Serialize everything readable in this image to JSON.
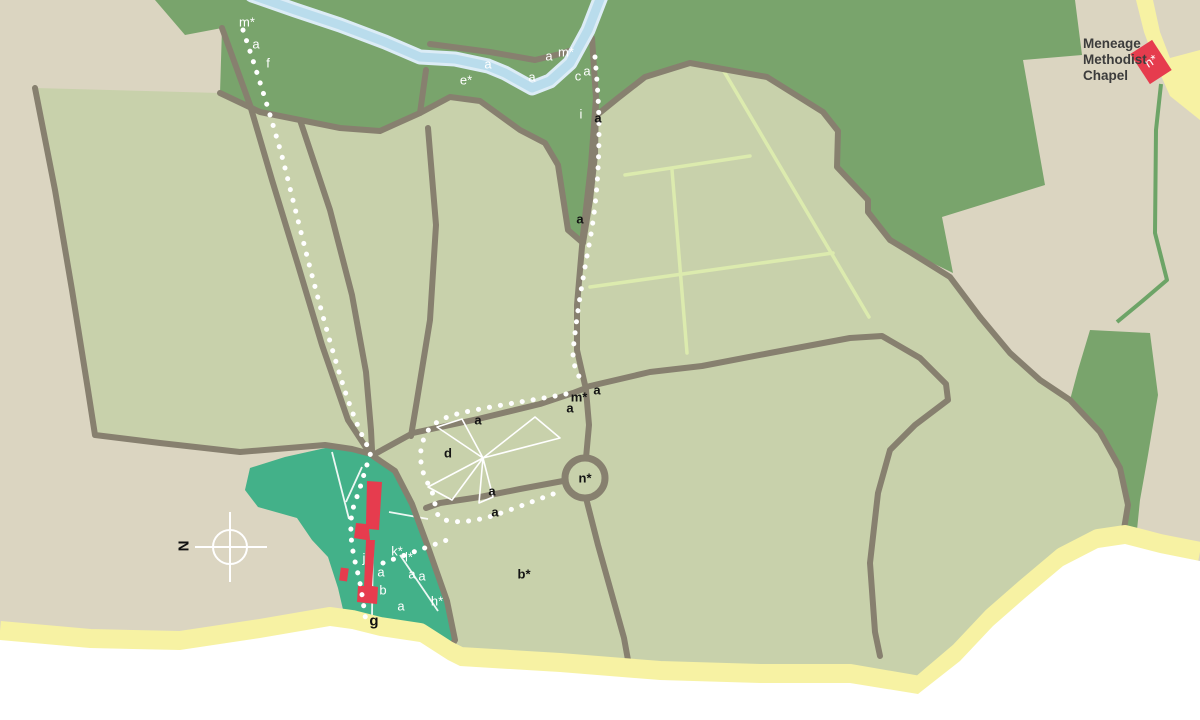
{
  "map": {
    "title": "Field and footpath map with Meneage Methodist Chapel",
    "chapel": {
      "line1": "Meneage",
      "line2": "Methodist",
      "line3": "Chapel",
      "marker": "n*"
    },
    "north_letter": "N",
    "colors": {
      "land_tan": "#dbd5c1",
      "field_green": "#c8d1ab",
      "woodland_green": "#79a46c",
      "village_green": "#43b189",
      "building_red": "#e63c4e",
      "path_yellow": "#f7f2a3",
      "river_blue": "#b9dcec",
      "river_edge": "#dcecf6",
      "hedge_grey": "#87806f",
      "grid_line_green": "#dcebae",
      "green_lane": "#6da467",
      "footpath_white": "#ffffff",
      "sea_white": "#ffffff"
    },
    "icons": {
      "north_arrow": "north-arrow-icon",
      "windmill": "windmill-sails-icon",
      "roundabout": "roundabout-circle"
    },
    "labels": [
      {
        "text": "m*",
        "x": 247,
        "y": 22,
        "style": "white"
      },
      {
        "text": "a",
        "x": 256,
        "y": 44,
        "style": "white"
      },
      {
        "text": "f",
        "x": 268,
        "y": 63,
        "style": "white"
      },
      {
        "text": "e*",
        "x": 466,
        "y": 80,
        "style": "white"
      },
      {
        "text": "a",
        "x": 488,
        "y": 64,
        "style": "white"
      },
      {
        "text": "a",
        "x": 532,
        "y": 77,
        "style": "white"
      },
      {
        "text": "a",
        "x": 549,
        "y": 56,
        "style": "white"
      },
      {
        "text": "m*",
        "x": 566,
        "y": 52,
        "style": "white"
      },
      {
        "text": "c",
        "x": 578,
        "y": 76,
        "style": "white"
      },
      {
        "text": "a",
        "x": 587,
        "y": 71,
        "style": "white"
      },
      {
        "text": "i",
        "x": 581,
        "y": 114,
        "style": "white"
      },
      {
        "text": "a",
        "x": 598,
        "y": 118,
        "style": "black"
      },
      {
        "text": "a",
        "x": 580,
        "y": 219,
        "style": "black"
      },
      {
        "text": "a",
        "x": 478,
        "y": 420,
        "style": "black"
      },
      {
        "text": "m*",
        "x": 579,
        "y": 397,
        "style": "black"
      },
      {
        "text": "a",
        "x": 597,
        "y": 390,
        "style": "black"
      },
      {
        "text": "a",
        "x": 570,
        "y": 408,
        "style": "black"
      },
      {
        "text": "d",
        "x": 448,
        "y": 453,
        "style": "black"
      },
      {
        "text": "a",
        "x": 492,
        "y": 491,
        "style": "black"
      },
      {
        "text": "a",
        "x": 495,
        "y": 512,
        "style": "black"
      },
      {
        "text": "n*",
        "x": 585,
        "y": 478,
        "style": "black"
      },
      {
        "text": "b*",
        "x": 524,
        "y": 574,
        "style": "black"
      },
      {
        "text": "j",
        "x": 364,
        "y": 558,
        "style": "white"
      },
      {
        "text": "k*",
        "x": 397,
        "y": 551,
        "style": "white"
      },
      {
        "text": "l*",
        "x": 409,
        "y": 557,
        "style": "white"
      },
      {
        "text": "a",
        "x": 381,
        "y": 572,
        "style": "white"
      },
      {
        "text": "a",
        "x": 412,
        "y": 574,
        "style": "white"
      },
      {
        "text": "a",
        "x": 422,
        "y": 576,
        "style": "white"
      },
      {
        "text": "b",
        "x": 383,
        "y": 590,
        "style": "white"
      },
      {
        "text": "a",
        "x": 401,
        "y": 606,
        "style": "white"
      },
      {
        "text": "h*",
        "x": 437,
        "y": 601,
        "style": "white"
      },
      {
        "text": "g",
        "x": 374,
        "y": 621,
        "style": "black-lg"
      },
      {
        "text": "n*",
        "x": 1151,
        "y": 61,
        "style": "white",
        "rotate": -33
      },
      {
        "text": "N",
        "x": 184,
        "y": 546,
        "style": "black-lg",
        "rotate": -90
      }
    ]
  }
}
